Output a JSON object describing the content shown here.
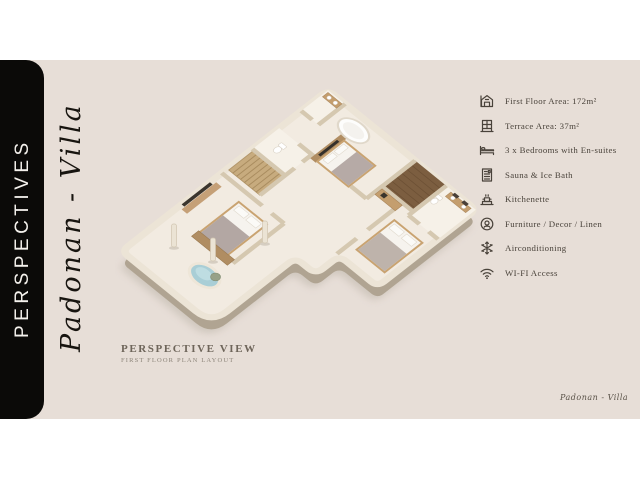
{
  "page": {
    "background": "#ffffff",
    "slide_background": "#e7ded7"
  },
  "sidebar": {
    "title": "PERSPECTIVES",
    "background": "#0b0a08",
    "text_color": "#f4f1ec"
  },
  "branding": {
    "villa_name_vertical": "Padonan - Villa",
    "signature": "Padonan - Villa"
  },
  "caption": {
    "title": "PERSPECTIVE VIEW",
    "subtitle": "FIRST FLOOR PLAN LAYOUT"
  },
  "features": {
    "items": [
      {
        "icon": "house-icon",
        "label": "First Floor Area: 172m²"
      },
      {
        "icon": "terrace-icon",
        "label": "Terrace Area: 37m²"
      },
      {
        "icon": "bed-icon",
        "label": "3 x Bedrooms with En-suites"
      },
      {
        "icon": "sauna-icon",
        "label": "Sauna & Ice Bath"
      },
      {
        "icon": "kitchenette-icon",
        "label": "Kitchenette"
      },
      {
        "icon": "furniture-icon",
        "label": "Furniture / Decor / Linen"
      },
      {
        "icon": "snowflake-icon",
        "label": "Airconditioning"
      },
      {
        "icon": "wifi-icon",
        "label": "WI-FI Access"
      }
    ]
  },
  "floor_plan": {
    "view": "isometric 3D render of first floor",
    "visible_elements": [
      "master bedroom with freestanding bathtub",
      "two further bedrooms with en-suite bathrooms",
      "staircase",
      "dark wood sauna room",
      "kitchenette console",
      "terrace with plunge pool and tree",
      "wardrobes, TV wall and columns"
    ],
    "colors": {
      "floor": "#f2ebe1",
      "walls": "#d5c8b0",
      "wall_face": "#b0a492",
      "dark_wood": "#7c5e40",
      "light_wood": "#c9a371",
      "pool": "#a9ced6",
      "linen": "#f6f3ee",
      "blanket": "#b3a7a3",
      "shadow": "#ccc4ba"
    }
  }
}
